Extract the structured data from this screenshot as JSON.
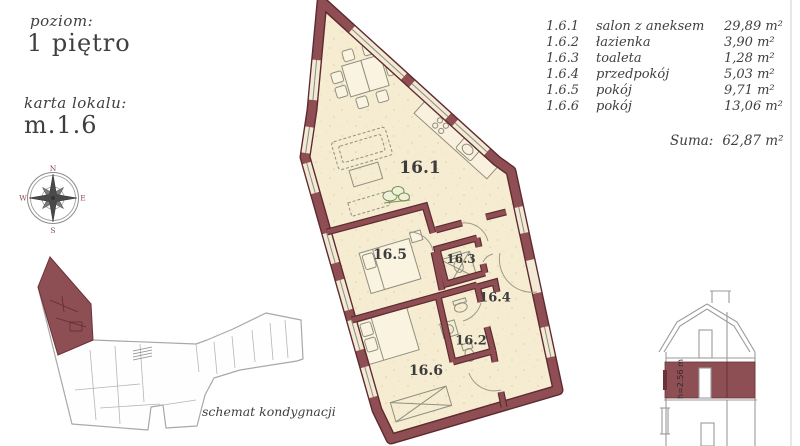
{
  "document": {
    "level_label": "poziom:",
    "level_value": "1 piętro",
    "card_label": "karta lokalu:",
    "card_value": "m.1.6",
    "schematic_caption": "schemat kondygnacji"
  },
  "compass": {
    "north": "N",
    "east": "E",
    "south": "S",
    "west": "W"
  },
  "legend": {
    "rows": [
      {
        "code": "1.6.1",
        "name": "salon z aneksem",
        "area": "29,89 m²"
      },
      {
        "code": "1.6.2",
        "name": "łazienka",
        "area": "3,90 m²"
      },
      {
        "code": "1.6.3",
        "name": "toaleta",
        "area": "1,28 m²"
      },
      {
        "code": "1.6.4",
        "name": "przedpokój",
        "area": "5,03 m²"
      },
      {
        "code": "1.6.5",
        "name": "pokój",
        "area": "9,71 m²"
      },
      {
        "code": "1.6.6",
        "name": "pokój",
        "area": "13,06 m²"
      }
    ],
    "total_label": "Suma:",
    "total_value": "62,87 m²"
  },
  "plan": {
    "room_labels": [
      {
        "text": "16.1"
      },
      {
        "text": "16.5"
      },
      {
        "text": "16.3"
      },
      {
        "text": "16.4"
      },
      {
        "text": "16.2"
      },
      {
        "text": "16.6"
      }
    ]
  },
  "cross_section": {
    "height_label": "h=2.56 m"
  },
  "colors": {
    "wall": "#8e4e53",
    "wall_edge": "#5d2b2f",
    "floor": "#f6ecd2",
    "highlight": "#8e4f54"
  }
}
